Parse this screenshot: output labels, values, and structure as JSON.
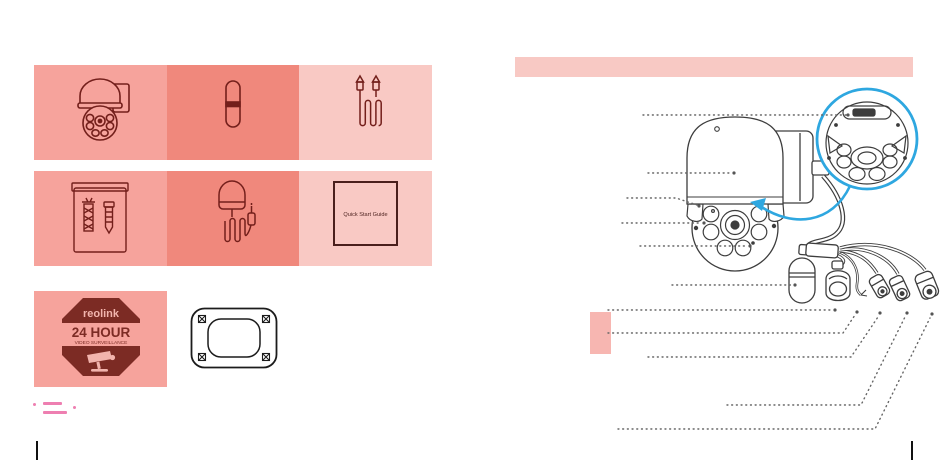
{
  "left_page": {
    "box_tiles": [
      {
        "icon": "ptz-camera-icon"
      },
      {
        "icon": "antenna-icon"
      },
      {
        "icon": "antenna-extension-cable-icon"
      },
      {
        "icon": "screw-pack-icon"
      },
      {
        "icon": "power-adapter-icon"
      },
      {
        "icon": "quick-start-guide-icon",
        "label": "Quick Start Guide"
      }
    ],
    "sticker": {
      "icon": "surveillance-sticker-icon",
      "brand": "reolink",
      "title": "24 HOUR",
      "subtitle": "VIDEO SURVEILLANCE",
      "glyph": "cctv-camera-icon"
    },
    "mounting_template_icon": "mounting-hole-template-icon",
    "footnote_marks_icon": "pink-dash-marks"
  },
  "right_page": {
    "title_bar_text": "",
    "diagram": {
      "camera_icon": "ptz-camera-illustration",
      "inset_icon": "camera-bottom-closeup",
      "arrow_icon": "blue-curved-arrow",
      "leader_line_count": 11
    }
  },
  "colors": {
    "tile_pink": "#f6a39c",
    "tile_pink_dark": "#f0887c",
    "tile_pink_light": "#f9c9c4",
    "icon_maroon": "#731f1b",
    "sticker_maroon": "#7c2b24",
    "accent_blue": "#2ea7e0",
    "title_bar_pink": "#f8c9c4",
    "highlight_pink": "#f7b6b1",
    "footnote_pink": "#ee7fb1",
    "diagram_line": "#3d3d3d",
    "leader_gray": "#666666"
  }
}
